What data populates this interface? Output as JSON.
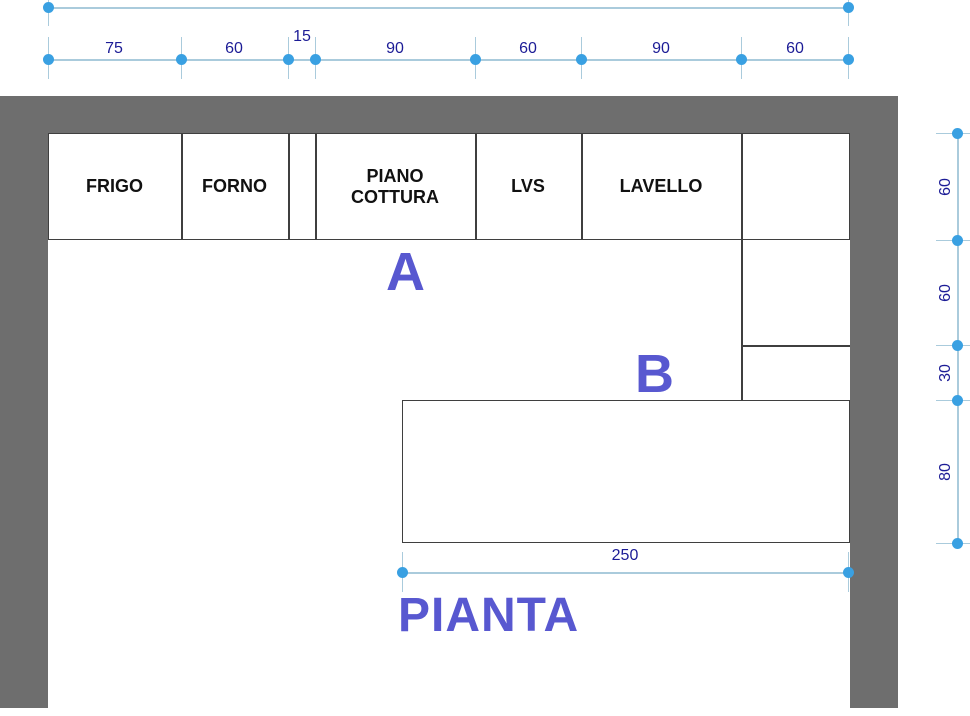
{
  "title": "PIANTA",
  "zones": {
    "a": "A",
    "b": "B"
  },
  "dims": {
    "top_total": "450",
    "top": [
      "75",
      "60",
      "15",
      "90",
      "60",
      "90",
      "60"
    ],
    "right": [
      "60",
      "60",
      "30",
      "80"
    ],
    "bottom": "250"
  },
  "cabinets": [
    {
      "label": "FRIGO"
    },
    {
      "label": "FORNO"
    },
    {
      "label": ""
    },
    {
      "label": "PIANO\nCOTTURA"
    },
    {
      "label": "LVS"
    },
    {
      "label": "LAVELLO"
    },
    {
      "label": ""
    }
  ],
  "colors": {
    "wall_gray": "#6e6e6e",
    "outline": "#3f3f3f",
    "dimension_line": "#aacbdc",
    "dimension_dot": "#39a0e2",
    "dimension_text": "#1c1c96",
    "zone_blue": "#5858d0"
  }
}
